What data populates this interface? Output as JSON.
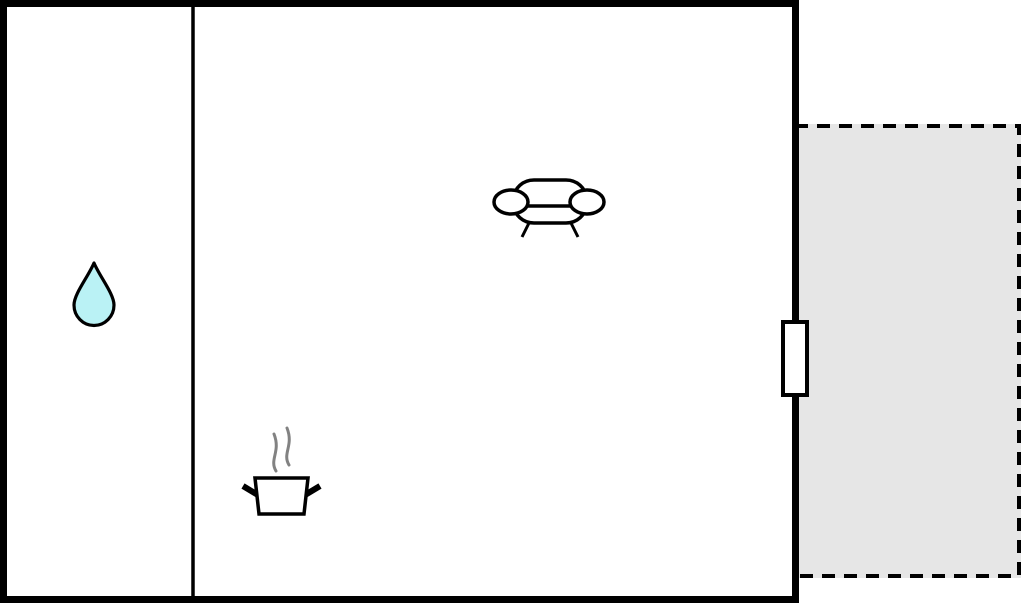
{
  "title": "Apartment floor plan",
  "colors": {
    "wall": "#000000",
    "room_fill": "#ffffff",
    "terrace_fill": "#e6e6e6",
    "door_fill": "#ffffff",
    "drop_fill": "#baf2f5",
    "steam": "#828282"
  },
  "floorplan": {
    "building": {
      "outline": "solid thick black rectangle",
      "rooms": [
        {
          "id": "left-room",
          "features": [
            "water-drop"
          ]
        },
        {
          "id": "main-room",
          "features": [
            "sofa",
            "cooking-pot-with-steam"
          ]
        }
      ],
      "interior_walls": 1,
      "door": {
        "wall": "right",
        "style": "white rectangle on wall"
      }
    },
    "terrace": {
      "outline": "dashed black rectangle",
      "fill": "light gray",
      "attached_side": "right"
    },
    "icons": [
      {
        "name": "water-drop-icon",
        "room": "left-room"
      },
      {
        "name": "sofa-icon",
        "room": "main-room"
      },
      {
        "name": "cooking-pot-icon",
        "room": "main-room"
      }
    ]
  }
}
